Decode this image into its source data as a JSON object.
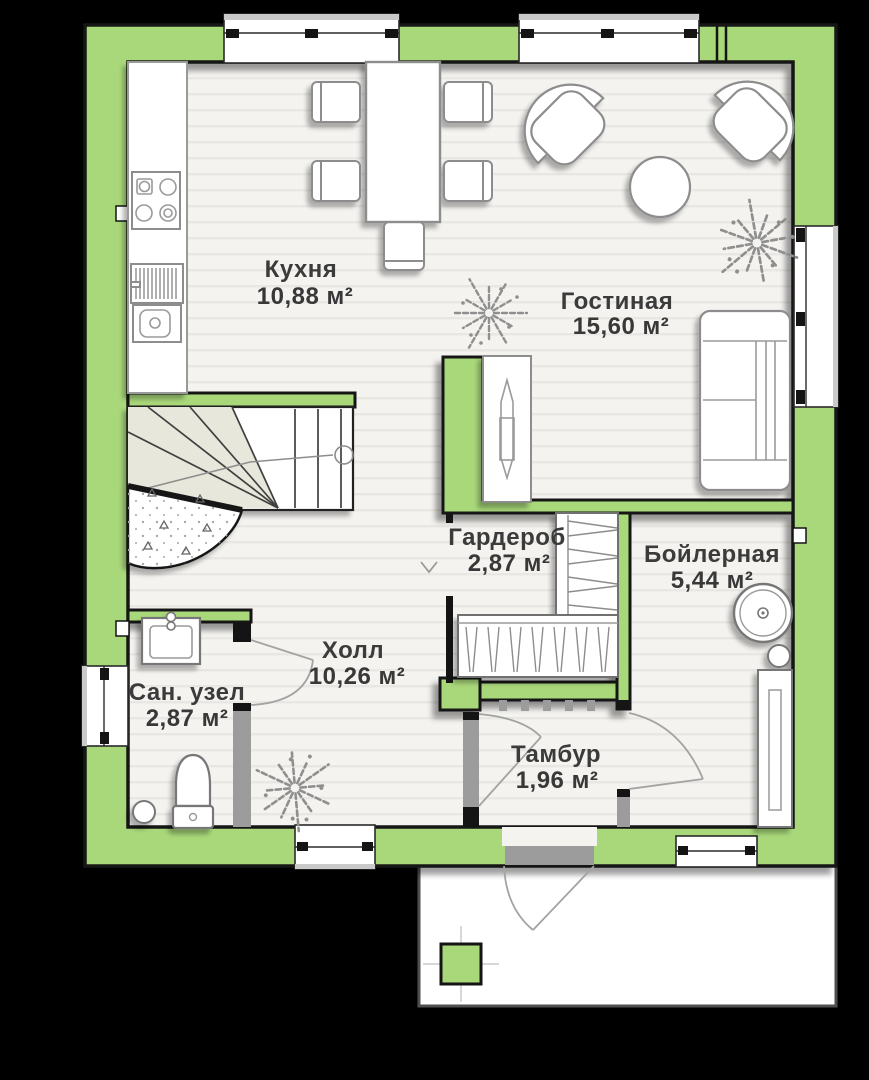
{
  "plan_title": "floor-plan-level-1",
  "colors": {
    "background": "#000000",
    "wall": "#a9d87a",
    "wall_outline": "#141414",
    "floor": "#f4f3f0",
    "floor_stripe": "#e9e7e3",
    "partition_gray": "#9c9c9c",
    "furniture_outline": "#8d8d8d",
    "winder_shade": "#e7e7db",
    "label": "#3b3b3b"
  },
  "rooms": [
    {
      "id": "kitchen",
      "name": "Кухня",
      "area": "10,88 м²"
    },
    {
      "id": "living",
      "name": "Гостиная",
      "area": "15,60 м²"
    },
    {
      "id": "wardrobe",
      "name": "Гардероб",
      "area": "2,87 м²"
    },
    {
      "id": "boiler",
      "name": "Бойлерная",
      "area": "5,44 м²"
    },
    {
      "id": "hall",
      "name": "Холл",
      "area": "10,26 м²"
    },
    {
      "id": "bathroom",
      "name": "Сан. узел",
      "area": "2,87 м²"
    },
    {
      "id": "vestibule",
      "name": "Тамбур",
      "area": "1,96 м²"
    }
  ],
  "furniture_icons": [
    "stove-icon",
    "drying-rack-icon",
    "kitchen-sink-icon",
    "dining-table-icon",
    "chair-icon",
    "armchair-icon",
    "coffee-table-icon",
    "sofa-icon",
    "tv-unit-icon",
    "stairs-icon",
    "understair-closet-icon",
    "shelving-icon",
    "clothes-rail-icon",
    "boiler-tank-icon",
    "water-heater-icon",
    "vanity-sink-icon",
    "toilet-icon",
    "floor-drain-icon",
    "plant-icon",
    "porch-column-icon",
    "door-swing-icon",
    "window-icon"
  ]
}
